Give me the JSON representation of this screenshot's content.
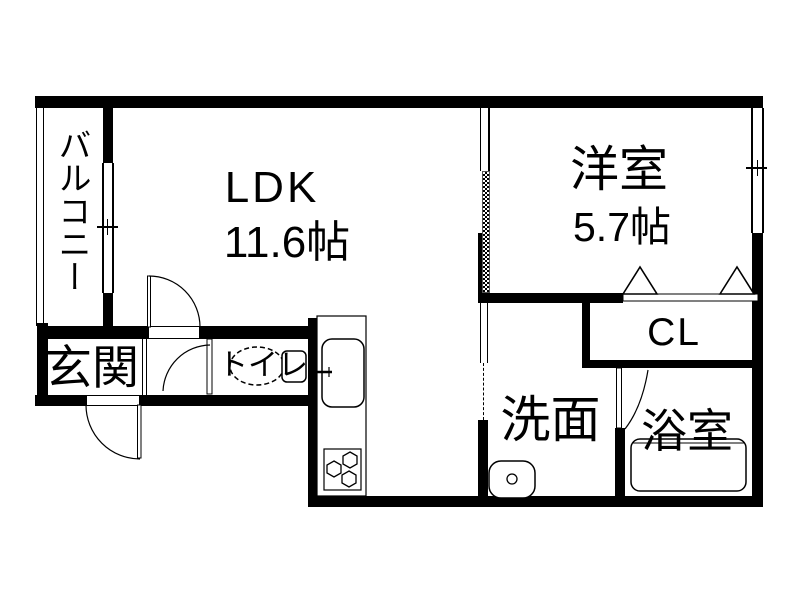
{
  "plan": {
    "type": "floorplan",
    "balcony": {
      "label": "バルコニー"
    },
    "ldk": {
      "label": "LDK",
      "area": "11.6帖"
    },
    "western_room": {
      "label": "洋室",
      "area": "5.7帖"
    },
    "closet": {
      "label": "CL"
    },
    "entrance": {
      "label": "玄関"
    },
    "toilet": {
      "label": "トイレ"
    },
    "washroom": {
      "label": "洗面"
    },
    "bathroom": {
      "label": "浴室"
    },
    "colors": {
      "wall": "#000000",
      "background": "#ffffff",
      "line": "#000000"
    }
  }
}
